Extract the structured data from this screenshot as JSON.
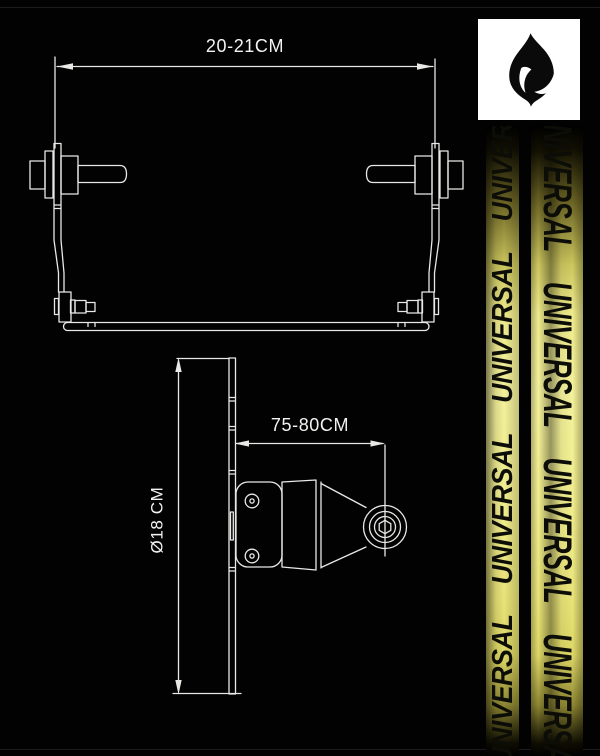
{
  "brand": {
    "name": "UNIVERSAL"
  },
  "logo": {
    "icon": "flame-icon",
    "bg_color": "#ffffff",
    "icon_color": "#0a0a0a"
  },
  "straps": {
    "yellow_main": "#f0ec84",
    "yellow_bright": "#f6f3a2",
    "text_color": "#0d0d08"
  },
  "drawing": {
    "line_color": "#e8e8e6",
    "label_color": "#f2f2f0",
    "front_view": {
      "width_label": "20-21CM"
    },
    "side_view": {
      "length_label": "75-80CM",
      "diameter_label": "Ø18 CM"
    }
  }
}
